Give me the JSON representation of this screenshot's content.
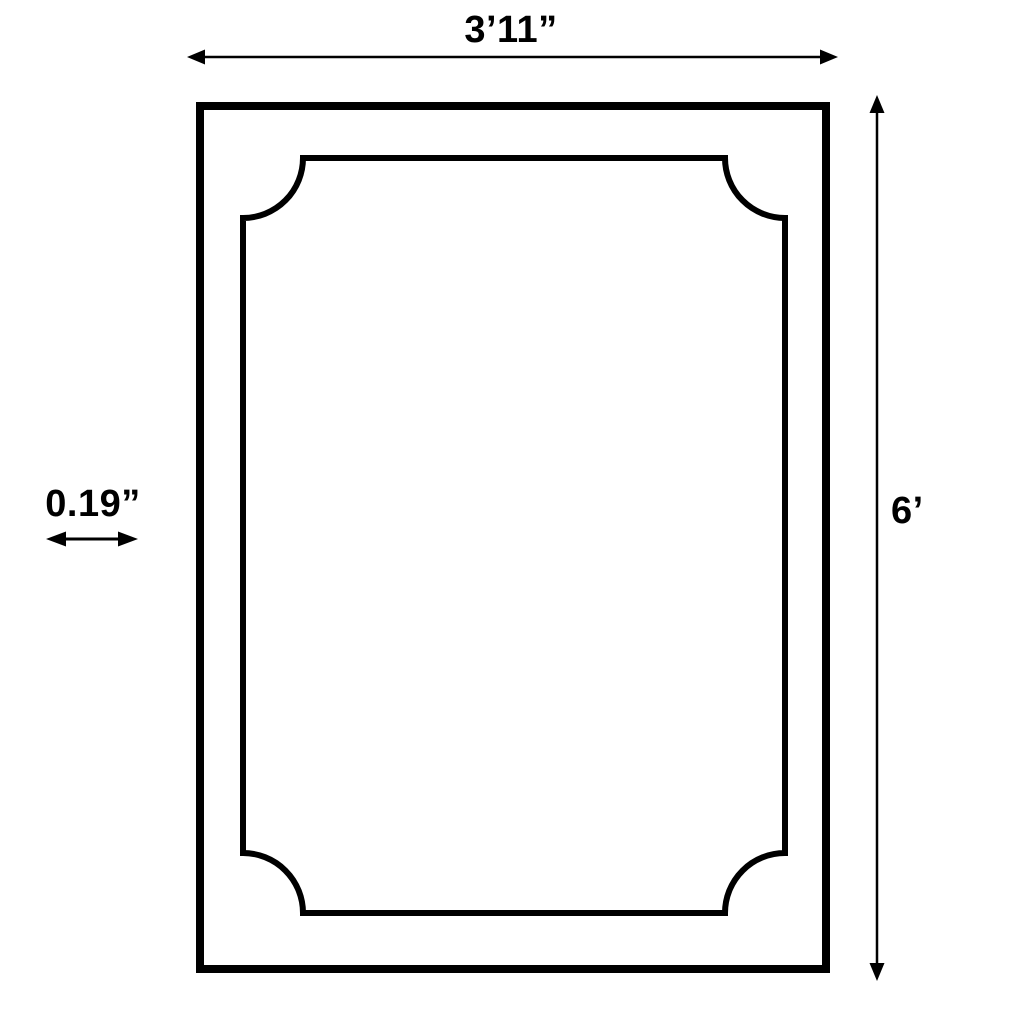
{
  "colors": {
    "background": "#ffffff",
    "line": "#000000"
  },
  "diagram": {
    "dimensions": {
      "width": {
        "label": "3’11”"
      },
      "height": {
        "label": "6’"
      },
      "thickness": {
        "label": "0.19”"
      }
    }
  }
}
